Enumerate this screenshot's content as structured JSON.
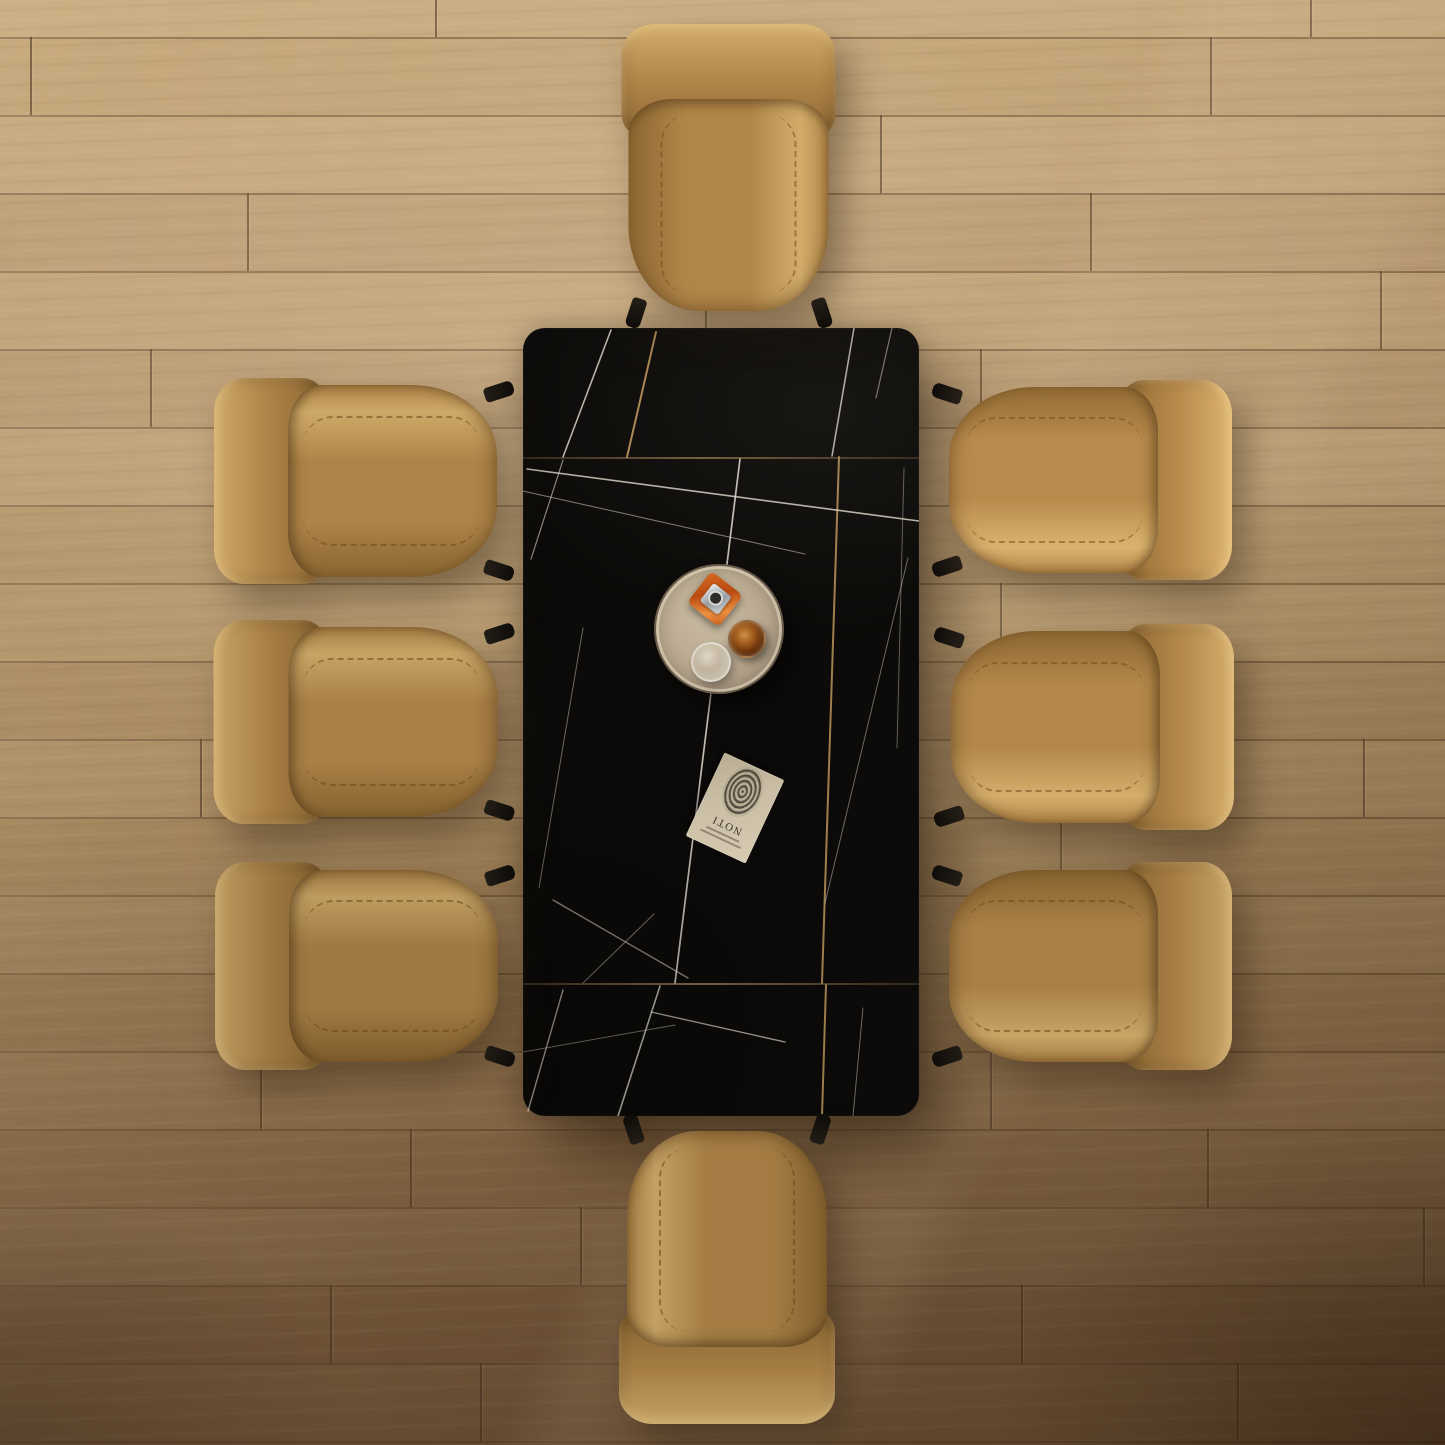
{
  "canvas": {
    "w": 1445,
    "h": 1445
  },
  "palette": {
    "floor_top": "#c9ab7f",
    "floor_bottom": "#7a5b3d",
    "plank_seam": "#46301e",
    "table_black": "#0c0b09",
    "vein_silver": "#e2dcd0",
    "vein_gold": "#c69c5f",
    "leather_base": "#ad8347",
    "leather_highlight": "#cfa968",
    "leather_shadow": "#8a6531",
    "leg_black": "#17120d",
    "tray_base": "#b8a88f",
    "tray_rim": "#eee4cb",
    "bottle_orange": "#c8551e",
    "bottle_cap_silver": "#b6bcc0",
    "glass_amber": "#7e3c10",
    "glass_clear": "#d7d0c4",
    "book_cover": "#cdc1a8",
    "fingerprint_ink": "#37302a"
  },
  "floor": {
    "plank_height": 78,
    "rows": [
      {
        "y": 0,
        "h": 37,
        "shade": 0.03,
        "seams": [
          435,
          1310
        ]
      },
      {
        "y": 37,
        "h": 78,
        "shade": -0.02,
        "seams": [
          30,
          1210
        ]
      },
      {
        "y": 115,
        "h": 78,
        "shade": 0.04,
        "seams": [
          880
        ]
      },
      {
        "y": 193,
        "h": 78,
        "shade": -0.03,
        "seams": [
          247,
          1090
        ]
      },
      {
        "y": 271,
        "h": 78,
        "shade": 0.02,
        "seams": [
          705,
          1380
        ]
      },
      {
        "y": 349,
        "h": 78,
        "shade": -0.04,
        "seams": [
          150,
          980
        ]
      },
      {
        "y": 427,
        "h": 78,
        "shade": 0.03,
        "seams": [
          1020
        ]
      },
      {
        "y": 505,
        "h": 78,
        "shade": -0.02,
        "seams": [
          260
        ]
      },
      {
        "y": 583,
        "h": 78,
        "shade": 0.02,
        "seams": [
          1000
        ]
      },
      {
        "y": 661,
        "h": 78,
        "shade": -0.03,
        "seams": [
          340
        ]
      },
      {
        "y": 739,
        "h": 78,
        "shade": 0.03,
        "seams": [
          200,
          1363
        ]
      },
      {
        "y": 817,
        "h": 78,
        "shade": -0.02,
        "seams": [
          1060
        ]
      },
      {
        "y": 895,
        "h": 78,
        "shade": 0.02,
        "seams": [
          300
        ]
      },
      {
        "y": 973,
        "h": 78,
        "shade": -0.04,
        "seams": [
          890
        ]
      },
      {
        "y": 1051,
        "h": 78,
        "shade": 0.02,
        "seams": [
          260,
          990
        ]
      },
      {
        "y": 1129,
        "h": 78,
        "shade": -0.02,
        "seams": [
          410,
          1207
        ]
      },
      {
        "y": 1207,
        "h": 78,
        "shade": 0.03,
        "seams": [
          580,
          1423
        ]
      },
      {
        "y": 1285,
        "h": 78,
        "shade": -0.03,
        "seams": [
          330,
          1021
        ]
      },
      {
        "y": 1363,
        "h": 78,
        "shade": 0.02,
        "seams": [
          480,
          1237
        ]
      },
      {
        "y": 1441,
        "h": 4,
        "shade": 0,
        "seams": []
      }
    ]
  },
  "table": {
    "x": 523,
    "y": 328,
    "w": 396,
    "h": 788,
    "radius": 22,
    "seams_y": [
      129,
      655
    ],
    "veins": [
      {
        "x1": 88,
        "y1": 2,
        "x2": 40,
        "y2": 129,
        "w": 1.6,
        "o": 0.8,
        "c": "s"
      },
      {
        "x1": 133,
        "y1": 4,
        "x2": 104,
        "y2": 129,
        "w": 2,
        "o": 0.85,
        "c": "g"
      },
      {
        "x1": 331,
        "y1": 0,
        "x2": 309,
        "y2": 128,
        "w": 1.6,
        "o": 0.75,
        "c": "s"
      },
      {
        "x1": 369,
        "y1": 0,
        "x2": 353,
        "y2": 70,
        "w": 1.2,
        "o": 0.5,
        "c": "s"
      },
      {
        "x1": 217,
        "y1": 131,
        "x2": 152,
        "y2": 655,
        "w": 1.7,
        "o": 0.85,
        "c": "s"
      },
      {
        "x1": 316,
        "y1": 129,
        "x2": 299,
        "y2": 655,
        "w": 2,
        "o": 0.8,
        "c": "g"
      },
      {
        "x1": 4,
        "y1": 141,
        "x2": 396,
        "y2": 193,
        "w": 1.6,
        "o": 0.8,
        "c": "s"
      },
      {
        "x1": 0,
        "y1": 163,
        "x2": 282,
        "y2": 226,
        "w": 1.1,
        "o": 0.5,
        "c": "s"
      },
      {
        "x1": 40,
        "y1": 132,
        "x2": 8,
        "y2": 231,
        "w": 1.2,
        "o": 0.6,
        "c": "s"
      },
      {
        "x1": 60,
        "y1": 300,
        "x2": 16,
        "y2": 560,
        "w": 1,
        "o": 0.45,
        "c": "s"
      },
      {
        "x1": 30,
        "y1": 572,
        "x2": 165,
        "y2": 650,
        "w": 1.3,
        "o": 0.6,
        "c": "s"
      },
      {
        "x1": 131,
        "y1": 586,
        "x2": 60,
        "y2": 655,
        "w": 1,
        "o": 0.5,
        "c": "s"
      },
      {
        "x1": 385,
        "y1": 230,
        "x2": 302,
        "y2": 575,
        "w": 1,
        "o": 0.45,
        "c": "s"
      },
      {
        "x1": 381,
        "y1": 140,
        "x2": 374,
        "y2": 420,
        "w": 1,
        "o": 0.4,
        "c": "s"
      },
      {
        "x1": 40,
        "y1": 662,
        "x2": 5,
        "y2": 783,
        "w": 1.4,
        "o": 0.7,
        "c": "s"
      },
      {
        "x1": 137,
        "y1": 658,
        "x2": 95,
        "y2": 788,
        "w": 1.6,
        "o": 0.8,
        "c": "s"
      },
      {
        "x1": 128,
        "y1": 684,
        "x2": 262,
        "y2": 714,
        "w": 1.4,
        "o": 0.7,
        "c": "s"
      },
      {
        "x1": 0,
        "y1": 724,
        "x2": 152,
        "y2": 697,
        "w": 1,
        "o": 0.5,
        "c": "s"
      },
      {
        "x1": 303,
        "y1": 657,
        "x2": 299,
        "y2": 788,
        "w": 2,
        "o": 0.8,
        "c": "g"
      },
      {
        "x1": 340,
        "y1": 680,
        "x2": 330,
        "y2": 788,
        "w": 1,
        "o": 0.45,
        "c": "s"
      }
    ]
  },
  "tray": {
    "x": 654,
    "y": 564,
    "size": 126,
    "bottle": {
      "cx": 59,
      "cy": 33,
      "size": 40,
      "rot": 38
    },
    "amber_glass": {
      "cx": 89,
      "cy": 71,
      "r": 17
    },
    "clear_glass": {
      "cx": 53,
      "cy": 94,
      "r": 18
    }
  },
  "book": {
    "cx": 735,
    "cy": 808,
    "w": 66,
    "h": 92,
    "rot": 205,
    "title": "NOTI"
  },
  "chairs": [
    {
      "id": "chair-north",
      "x": 619,
      "y": 24,
      "w": 219,
      "h": 290,
      "rot": 0,
      "len": 290,
      "wid": 219,
      "bright": 1.02
    },
    {
      "id": "chair-west-1",
      "x": 214,
      "y": 376,
      "w": 286,
      "h": 210,
      "rot": -90,
      "len": 286,
      "wid": 210,
      "bright": 1.0
    },
    {
      "id": "chair-west-2",
      "x": 213,
      "y": 618,
      "w": 287,
      "h": 208,
      "rot": -90,
      "len": 287,
      "wid": 208,
      "bright": 0.97
    },
    {
      "id": "chair-west-3",
      "x": 215,
      "y": 860,
      "w": 286,
      "h": 212,
      "rot": -90,
      "len": 286,
      "wid": 212,
      "bright": 0.92
    },
    {
      "id": "chair-east-1",
      "x": 946,
      "y": 378,
      "w": 286,
      "h": 204,
      "rot": 90,
      "len": 286,
      "wid": 204,
      "bright": 1.06
    },
    {
      "id": "chair-east-2",
      "x": 948,
      "y": 622,
      "w": 286,
      "h": 210,
      "rot": 90,
      "len": 286,
      "wid": 210,
      "bright": 1.03
    },
    {
      "id": "chair-east-3",
      "x": 946,
      "y": 860,
      "w": 286,
      "h": 212,
      "rot": 90,
      "len": 286,
      "wid": 212,
      "bright": 0.97
    },
    {
      "id": "chair-south",
      "x": 617,
      "y": 1128,
      "w": 220,
      "h": 296,
      "rot": 180,
      "len": 296,
      "wid": 220,
      "bright": 0.95
    }
  ]
}
